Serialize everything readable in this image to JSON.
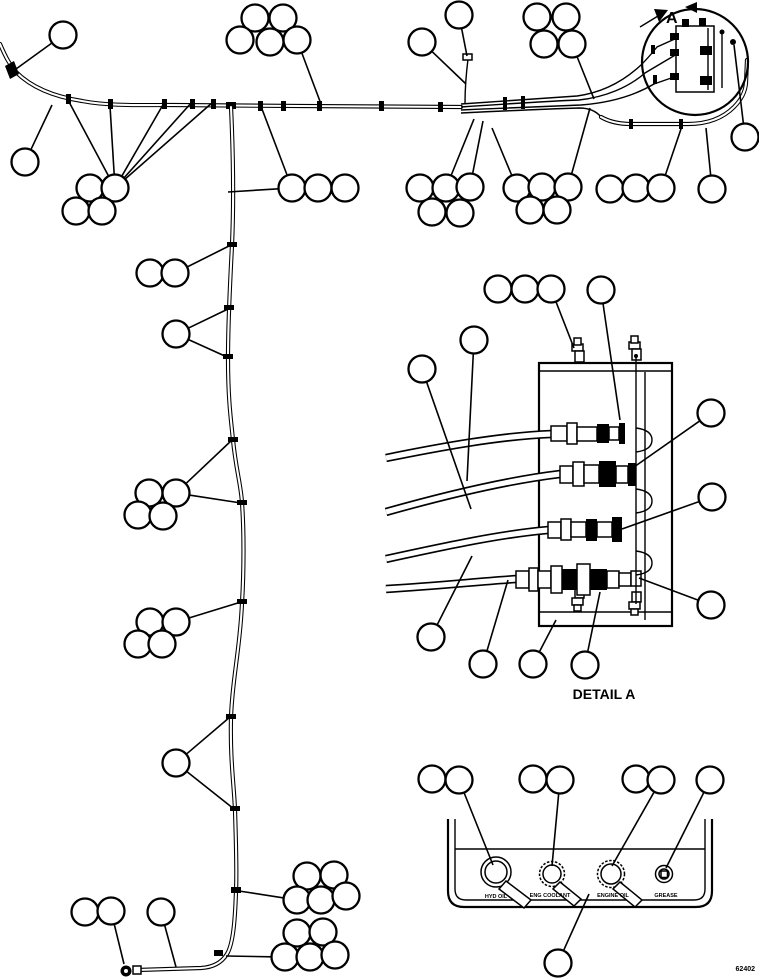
{
  "figure": {
    "view_label": "A",
    "detail_label": "DETAIL A",
    "doc_number": "62402"
  },
  "panel": {
    "ports": [
      {
        "label": "HYD OIL"
      },
      {
        "label": "ENG COOLANT"
      },
      {
        "label": "ENGINE OIL"
      },
      {
        "label": "GREASE"
      }
    ]
  },
  "colors": {
    "line": "#000000",
    "background": "#ffffff"
  },
  "balloons": [
    {
      "cx": 63,
      "cy": 35,
      "leaders": [
        [
          16,
          69
        ]
      ]
    },
    {
      "cx": 25,
      "cy": 162,
      "leaders": [
        [
          52,
          105
        ]
      ]
    },
    {
      "cx": 90,
      "cy": 188,
      "leaders": []
    },
    {
      "cx": 115,
      "cy": 188,
      "leaders": [
        [
          68,
          100
        ],
        [
          110,
          106
        ],
        [
          164,
          103
        ],
        [
          192,
          102
        ],
        [
          213,
          102
        ]
      ]
    },
    {
      "cx": 76,
      "cy": 211,
      "leaders": []
    },
    {
      "cx": 102,
      "cy": 211,
      "leaders": []
    },
    {
      "cx": 255,
      "cy": 18,
      "leaders": []
    },
    {
      "cx": 283,
      "cy": 18,
      "leaders": []
    },
    {
      "cx": 240,
      "cy": 40,
      "leaders": []
    },
    {
      "cx": 270,
      "cy": 42,
      "leaders": []
    },
    {
      "cx": 297,
      "cy": 40,
      "leaders": [
        [
          321,
          104
        ]
      ]
    },
    {
      "cx": 292,
      "cy": 188,
      "leaders": [
        [
          262,
          109
        ],
        [
          228,
          192
        ]
      ]
    },
    {
      "cx": 318,
      "cy": 188,
      "leaders": []
    },
    {
      "cx": 345,
      "cy": 188,
      "leaders": []
    },
    {
      "cx": 422,
      "cy": 42,
      "leaders": [
        [
          466,
          84
        ]
      ]
    },
    {
      "cx": 459,
      "cy": 15,
      "leaders": [
        [
          467,
          56
        ]
      ]
    },
    {
      "cx": 537,
      "cy": 17,
      "leaders": []
    },
    {
      "cx": 566,
      "cy": 17,
      "leaders": []
    },
    {
      "cx": 544,
      "cy": 44,
      "leaders": []
    },
    {
      "cx": 572,
      "cy": 44,
      "leaders": [
        [
          594,
          99
        ]
      ]
    },
    {
      "cx": 420,
      "cy": 188,
      "leaders": []
    },
    {
      "cx": 446,
      "cy": 188,
      "leaders": [
        [
          474,
          119
        ]
      ]
    },
    {
      "cx": 470,
      "cy": 187,
      "leaders": [
        [
          483,
          121
        ]
      ]
    },
    {
      "cx": 432,
      "cy": 212,
      "leaders": []
    },
    {
      "cx": 460,
      "cy": 213,
      "leaders": []
    },
    {
      "cx": 517,
      "cy": 188,
      "leaders": [
        [
          492,
          128
        ]
      ]
    },
    {
      "cx": 542,
      "cy": 187,
      "leaders": []
    },
    {
      "cx": 568,
      "cy": 187,
      "leaders": [
        [
          590,
          108
        ]
      ]
    },
    {
      "cx": 530,
      "cy": 210,
      "leaders": []
    },
    {
      "cx": 557,
      "cy": 210,
      "leaders": []
    },
    {
      "cx": 610,
      "cy": 189,
      "leaders": []
    },
    {
      "cx": 636,
      "cy": 188,
      "leaders": []
    },
    {
      "cx": 661,
      "cy": 188,
      "leaders": [
        [
          682,
          126
        ]
      ]
    },
    {
      "cx": 712,
      "cy": 189,
      "leaders": [
        [
          706,
          128
        ]
      ]
    },
    {
      "cx": 745,
      "cy": 137,
      "leaders": [
        [
          734,
          45
        ]
      ]
    },
    {
      "cx": 150,
      "cy": 273,
      "leaders": []
    },
    {
      "cx": 175,
      "cy": 273,
      "leaders": [
        [
          229,
          246
        ]
      ]
    },
    {
      "cx": 176,
      "cy": 334,
      "leaders": [
        [
          228,
          309
        ],
        [
          227,
          357
        ]
      ]
    },
    {
      "cx": 149,
      "cy": 493,
      "leaders": []
    },
    {
      "cx": 176,
      "cy": 493,
      "leaders": [
        [
          232,
          440
        ],
        [
          241,
          503
        ]
      ]
    },
    {
      "cx": 138,
      "cy": 515,
      "leaders": []
    },
    {
      "cx": 163,
      "cy": 516,
      "leaders": []
    },
    {
      "cx": 150,
      "cy": 622,
      "leaders": []
    },
    {
      "cx": 176,
      "cy": 622,
      "leaders": [
        [
          241,
          602
        ]
      ]
    },
    {
      "cx": 138,
      "cy": 644,
      "leaders": []
    },
    {
      "cx": 162,
      "cy": 644,
      "leaders": []
    },
    {
      "cx": 176,
      "cy": 763,
      "leaders": [
        [
          230,
          717
        ],
        [
          234,
          809
        ]
      ]
    },
    {
      "cx": 85,
      "cy": 912,
      "leaders": []
    },
    {
      "cx": 111,
      "cy": 911,
      "leaders": [
        [
          124,
          964
        ]
      ]
    },
    {
      "cx": 161,
      "cy": 912,
      "leaders": [
        [
          176,
          967
        ]
      ]
    },
    {
      "cx": 307,
      "cy": 876,
      "leaders": []
    },
    {
      "cx": 334,
      "cy": 875,
      "leaders": []
    },
    {
      "cx": 297,
      "cy": 900,
      "leaders": [
        [
          239,
          891
        ]
      ]
    },
    {
      "cx": 321,
      "cy": 900,
      "leaders": []
    },
    {
      "cx": 346,
      "cy": 896,
      "leaders": []
    },
    {
      "cx": 297,
      "cy": 933,
      "leaders": []
    },
    {
      "cx": 323,
      "cy": 932,
      "leaders": []
    },
    {
      "cx": 285,
      "cy": 957,
      "leaders": [
        [
          226,
          956
        ]
      ]
    },
    {
      "cx": 310,
      "cy": 957,
      "leaders": []
    },
    {
      "cx": 335,
      "cy": 955,
      "leaders": []
    },
    {
      "cx": 498,
      "cy": 289,
      "leaders": []
    },
    {
      "cx": 525,
      "cy": 289,
      "leaders": []
    },
    {
      "cx": 551,
      "cy": 289,
      "leaders": [
        [
          574,
          348
        ]
      ]
    },
    {
      "cx": 601,
      "cy": 290,
      "leaders": [
        [
          620,
          420
        ]
      ]
    },
    {
      "cx": 474,
      "cy": 340,
      "leaders": [
        [
          467,
          481
        ]
      ]
    },
    {
      "cx": 422,
      "cy": 369,
      "leaders": [
        [
          471,
          509
        ]
      ]
    },
    {
      "cx": 711,
      "cy": 413,
      "leaders": [
        [
          634,
          467
        ]
      ]
    },
    {
      "cx": 712,
      "cy": 497,
      "leaders": [
        [
          622,
          529
        ]
      ]
    },
    {
      "cx": 711,
      "cy": 605,
      "leaders": [
        [
          639,
          578
        ]
      ]
    },
    {
      "cx": 431,
      "cy": 637,
      "leaders": [
        [
          472,
          556
        ]
      ]
    },
    {
      "cx": 483,
      "cy": 664,
      "leaders": [
        [
          508,
          580
        ]
      ]
    },
    {
      "cx": 533,
      "cy": 664,
      "leaders": [
        [
          556,
          620
        ]
      ]
    },
    {
      "cx": 585,
      "cy": 665,
      "leaders": [
        [
          600,
          592
        ]
      ]
    },
    {
      "cx": 432,
      "cy": 779,
      "leaders": []
    },
    {
      "cx": 459,
      "cy": 780,
      "leaders": [
        [
          493,
          865
        ]
      ]
    },
    {
      "cx": 533,
      "cy": 779,
      "leaders": []
    },
    {
      "cx": 560,
      "cy": 780,
      "leaders": [
        [
          552,
          866
        ]
      ]
    },
    {
      "cx": 636,
      "cy": 779,
      "leaders": []
    },
    {
      "cx": 661,
      "cy": 780,
      "leaders": [
        [
          612,
          866
        ]
      ]
    },
    {
      "cx": 710,
      "cy": 780,
      "leaders": [
        [
          666,
          868
        ]
      ]
    },
    {
      "cx": 558,
      "cy": 963,
      "leaders": [
        [
          589,
          894
        ]
      ]
    }
  ]
}
